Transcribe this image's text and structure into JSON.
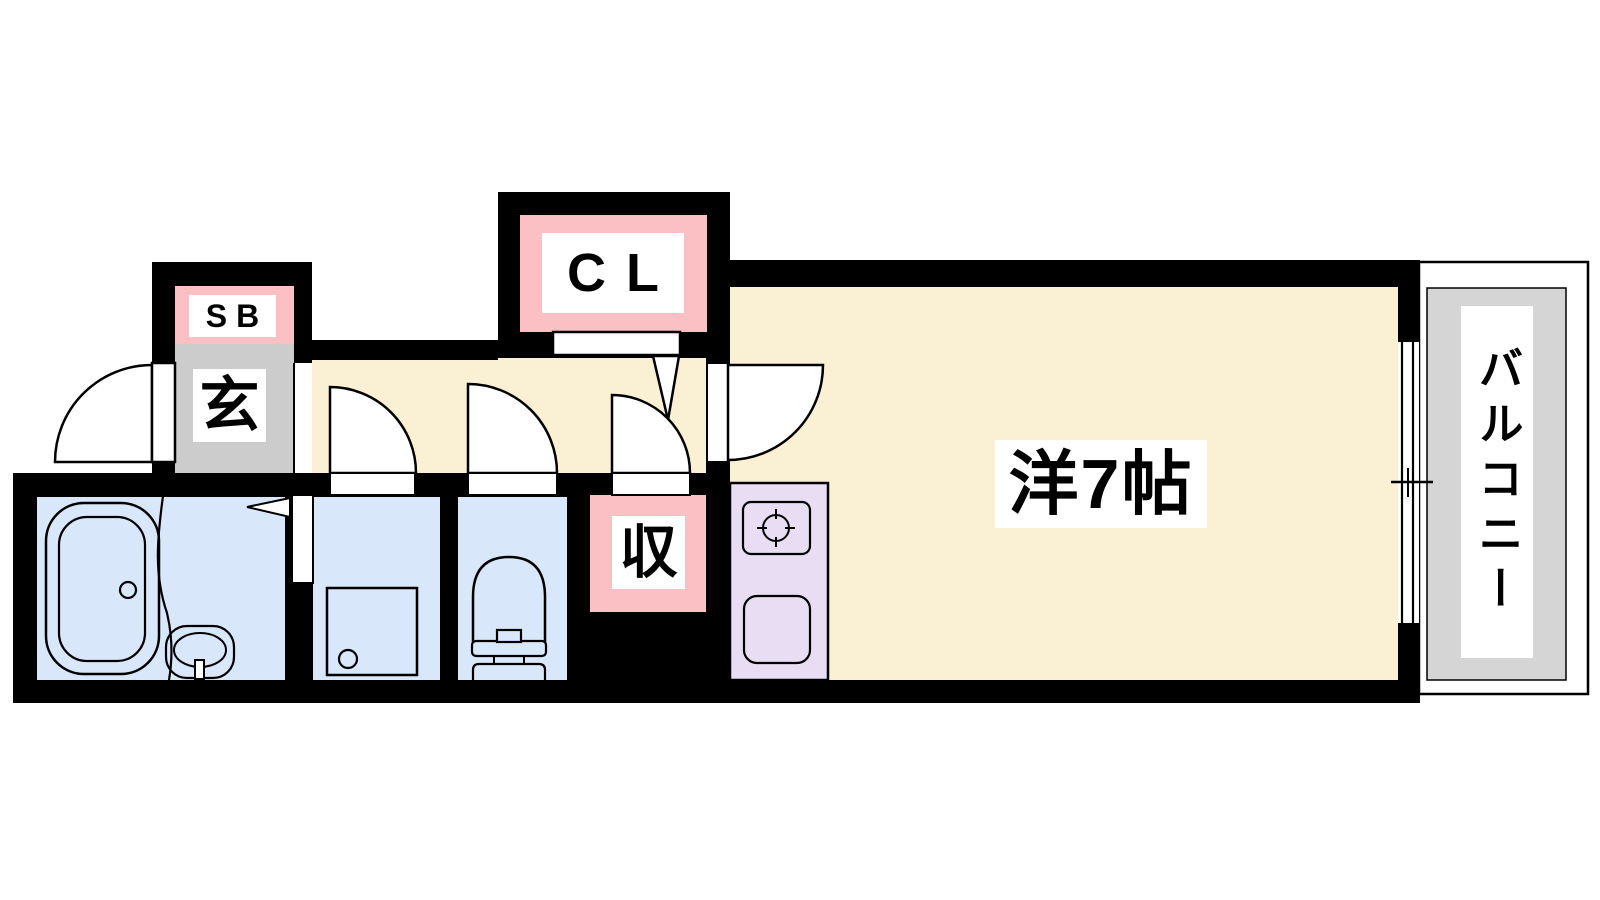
{
  "plan": {
    "title": "1K apartment floor plan",
    "labels": {
      "shoe_box": "SB",
      "entrance": "玄",
      "closet": "CL",
      "storage": "収",
      "main_room": "洋7帖",
      "balcony": "バルコニー"
    },
    "rooms": [
      {
        "id": "main_room",
        "label": "洋7帖",
        "fill": "#FAF1D4"
      },
      {
        "id": "hallway",
        "label": "",
        "fill": "#FAF1D4"
      },
      {
        "id": "entrance",
        "label": "玄",
        "fill": "#CCCCCC"
      },
      {
        "id": "shoe_box",
        "label": "SB",
        "fill": "#FAC0C3"
      },
      {
        "id": "closet",
        "label": "CL",
        "fill": "#FAC0C3"
      },
      {
        "id": "storage",
        "label": "収",
        "fill": "#FAC0C3"
      },
      {
        "id": "bathroom",
        "label": "",
        "fill": "#D9E7FA"
      },
      {
        "id": "laundry_room",
        "label": "",
        "fill": "#D9E7FA"
      },
      {
        "id": "toilet_room",
        "label": "",
        "fill": "#D9E7FA"
      },
      {
        "id": "kitchen",
        "label": "",
        "fill": "#E8DDF2"
      },
      {
        "id": "balcony",
        "label": "バルコニー",
        "fill": "#D5D5D5"
      }
    ],
    "colors": {
      "wall": "#000000",
      "room_cream": "#FAF1D4",
      "wet_blue": "#D9E7FA",
      "kitchen_purple": "#E8DDF2",
      "label_pink": "#FAC0C3",
      "entrance_gray": "#CCCCCC",
      "balcony_gray": "#D5D5D5",
      "label_bg": "#FFFFFF",
      "line": "#000000"
    }
  }
}
